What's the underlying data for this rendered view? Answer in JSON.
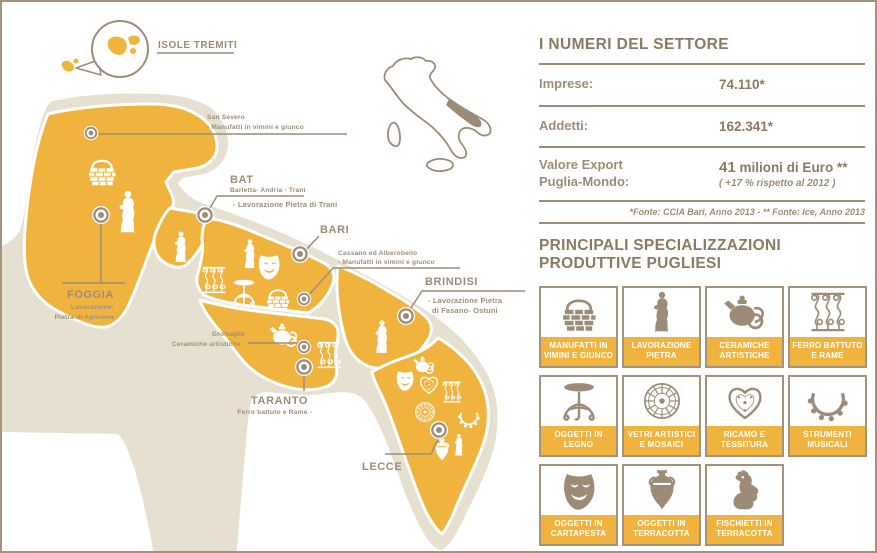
{
  "colors": {
    "yellow": "#F0B43E",
    "taupe": "#9C8C77",
    "dark_taupe": "#8A7A63",
    "beige": "#E6E0D1",
    "white": "#FFFFFF"
  },
  "map": {
    "tremiti_label": "ISOLE TREMITI",
    "san_severo_name": "San Severo",
    "san_severo_craft": "- Manufatti in vimini e giunco",
    "foggia_name": "FOGGIA",
    "foggia_craft_line1": "Lavorazione-",
    "foggia_craft_line2": "Pietra di Apricena",
    "bat_name": "BAT",
    "bat_sub": "Barletta- Andria - Trani",
    "bat_craft": "- Lavorazione Pietra di Trani",
    "bari_name": "BARI",
    "cassano_name": "Cassano ed Alberobello",
    "cassano_craft": "- Manufatti in vimini e giunco",
    "brindisi_name": "BRINDISI",
    "brindisi_craft_line1": "- Lavorazione Pietra",
    "brindisi_craft_line2": "di Fasano- Ostuni",
    "grottaglie_name": "Grottaglie",
    "grottaglie_craft": "Ceramiche artistiche -",
    "taranto_name": "TARANTO",
    "taranto_craft": "Ferro battuto e Rame -",
    "lecce_name": "LECCE",
    "province_icons": {
      "foggia": [
        "basket-icon",
        "statue-icon"
      ],
      "bat": [
        "statue-icon"
      ],
      "bari": [
        "statue-icon",
        "mask-icon",
        "wrought-iron-icon",
        "table-icon",
        "basket-icon"
      ],
      "taranto": [
        "teapot-icon",
        "wrought-iron-icon"
      ],
      "brindisi": [
        "statue-icon"
      ],
      "lecce": [
        "teapot-icon",
        "mask-icon",
        "heart-icon",
        "wrought-iron-icon",
        "mosaic-icon",
        "tambourine-icon",
        "amphora-icon",
        "statue-icon"
      ]
    }
  },
  "stats": {
    "title": "I NUMERI DEL SETTORE",
    "imprese_label": "Imprese:",
    "imprese_value": "74.110*",
    "addetti_label": "Addetti:",
    "addetti_value": "162.341*",
    "export_label_line1": "Valore Export",
    "export_label_line2": "Puglia-Mondo:",
    "export_value_bold": "41",
    "export_value_rest": " milioni di Euro **",
    "export_note": "( +17 % rispetto al 2012 )",
    "footnote": "*Fonte: CCIA Bari, Anno 2013 - ** Fonte: Ice, Anno 2013"
  },
  "specializations": {
    "title_line1": "PRINCIPALI SPECIALIZZAZIONI",
    "title_line2": "PRODUTTIVE PUGLIESI",
    "items": [
      {
        "icon": "basket-icon",
        "line1": "MANUFATTI IN",
        "line2": "VIMINI E GIUNCO"
      },
      {
        "icon": "statue-icon",
        "line1": "LAVORAZIONE",
        "line2": "PIETRA"
      },
      {
        "icon": "teapot-icon",
        "line1": "CERAMICHE",
        "line2": "ARTISTICHE"
      },
      {
        "icon": "wrought-iron-icon",
        "line1": "FERRO BATTUTO",
        "line2": "E RAME"
      },
      {
        "icon": "table-icon",
        "line1": "OGGETTI IN",
        "line2": "LEGNO"
      },
      {
        "icon": "mosaic-icon",
        "line1": "VETRI ARTISTICI",
        "line2": "E MOSAICI"
      },
      {
        "icon": "heart-icon",
        "line1": "RICAMO E",
        "line2": "TESSITURA"
      },
      {
        "icon": "tambourine-icon",
        "line1": "STRUMENTI",
        "line2": "MUSICALI"
      },
      {
        "icon": "mask-icon",
        "line1": "OGGETTI IN",
        "line2": "CARTAPESTA"
      },
      {
        "icon": "amphora-icon",
        "line1": "OGGETTI IN",
        "line2": "TERRACOTTA"
      },
      {
        "icon": "whistle-icon",
        "line1": "FISCHIETTI IN",
        "line2": "TERRACOTTA"
      }
    ]
  }
}
